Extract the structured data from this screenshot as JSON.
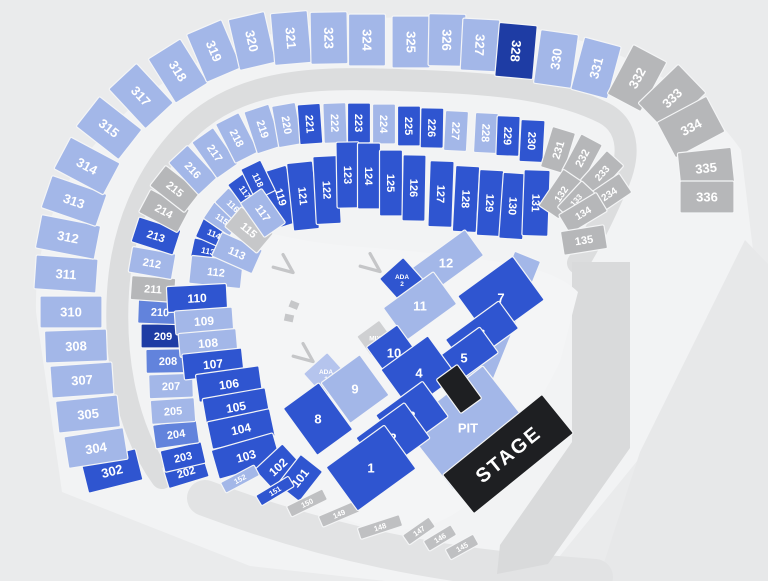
{
  "seat_map": {
    "palette": {
      "light": "#a3b7e8",
      "medium": "#6283dc",
      "royal": "#2f55d0",
      "navy": "#1e3ca4",
      "gray": "#b6b7b9",
      "graylight": "#c6c7c9",
      "strip": "#bfc0c2",
      "ada1": "#b5c4ed",
      "mix": "#cfd0d2",
      "stage": "#1e1f22",
      "stroke": "#f4f5f6",
      "arrow": "#c5c6c8"
    },
    "backdrops": [
      {
        "name": "stadium-footprint",
        "type": "path",
        "fill": "#f2f3f4",
        "d": "M 62 492 L 36 312 Q 33 198 121 117 Q 212 30 362 19 Q 522 8 632 61 Q 703 95 741 150 L 753 250 L 642 455 L 546 573 L 430 586 L 250 566 Z"
      },
      {
        "name": "outer-plaza",
        "type": "path",
        "fill": "#e7e8e9",
        "d": "M 745 240 L 768 264 L 768 581 L 598 581 L 640 452 Z"
      },
      {
        "name": "bottom-walkway",
        "type": "path",
        "stroke": "#e2e3e4",
        "w": 36,
        "d": "M 205 498 Q 360 556 520 571 L 595 577"
      },
      {
        "name": "concourse-ring",
        "type": "path",
        "stroke": "#dcddde",
        "w": 22,
        "d": "M 162 478 C 126 428 114 358 118 292 C 122 226 148 167 193 125 C 252 72 340 78 424 81 C 504 84 560 91 604 113 C 627 125 631 151 619 181 C 607 209 593 239 578 263"
      },
      {
        "name": "stage-right-walkway",
        "type": "path",
        "fill": "#d9dadb",
        "d": "M 572 262 L 630 262 L 630 448 L 548 564 L 497 574 L 500 545 L 572 442 Z"
      },
      {
        "name": "field-floor",
        "type": "path",
        "fill": "#f4f5f6",
        "d": "M 212 300 Q 214 242 252 228 Q 302 243 362 247 Q 432 252 500 262 Q 556 270 578 292 L 560 362 Q 520 442 470 502 Q 420 546 350 521 Q 272 492 237 452 Q 209 400 212 300 Z"
      },
      {
        "name": "wall-block",
        "type": "rect",
        "x": 294,
        "y": 305,
        "w": 9,
        "h": 7,
        "r": 22,
        "fill": "#c6c7c9"
      },
      {
        "name": "wall-block",
        "type": "rect",
        "x": 289,
        "y": 318,
        "w": 9,
        "h": 7,
        "r": 12,
        "fill": "#c6c7c9"
      }
    ],
    "sections": [
      [
        "302",
        112,
        471,
        56,
        32,
        -14,
        "royal",
        13
      ],
      [
        "304",
        96,
        448,
        60,
        32,
        -9,
        "light",
        13
      ],
      [
        "305",
        88,
        414,
        62,
        32,
        -6,
        "light",
        13
      ],
      [
        "307",
        82,
        380,
        62,
        32,
        -4,
        "light",
        13
      ],
      [
        "308",
        76,
        346,
        62,
        32,
        -2,
        "light",
        13
      ],
      [
        "310",
        71,
        312,
        62,
        32,
        0,
        "light",
        13
      ],
      [
        "311",
        66,
        274,
        62,
        34,
        4,
        "light",
        13
      ],
      [
        "312",
        68,
        237,
        60,
        34,
        11,
        "light",
        13
      ],
      [
        "313",
        74,
        201,
        58,
        34,
        19,
        "light",
        13
      ],
      [
        "314",
        87,
        166,
        56,
        36,
        28,
        "light",
        13
      ],
      [
        "315",
        109,
        128,
        54,
        38,
        38,
        "light",
        13
      ],
      [
        "317",
        141,
        96,
        54,
        38,
        47,
        "light",
        13
      ],
      [
        "318",
        178,
        71,
        52,
        38,
        58,
        "light",
        13
      ],
      [
        "319",
        214,
        51,
        52,
        38,
        67,
        "light",
        13
      ],
      [
        "320",
        252,
        41,
        52,
        37,
        77,
        "light",
        13
      ],
      [
        "321",
        291,
        38,
        52,
        37,
        85,
        "light",
        13
      ],
      [
        "323",
        329,
        38,
        52,
        37,
        89,
        "light",
        13
      ],
      [
        "324",
        367,
        40,
        52,
        37,
        90,
        "light",
        13
      ],
      [
        "325",
        411,
        42,
        52,
        38,
        90,
        "light",
        13
      ],
      [
        "326",
        447,
        40,
        52,
        37,
        91,
        "light",
        13
      ],
      [
        "327",
        480,
        45,
        52,
        37,
        93,
        "light",
        13
      ],
      [
        "328",
        516,
        51,
        54,
        38,
        95,
        "navy",
        13
      ],
      [
        "330",
        556,
        59,
        54,
        38,
        -82,
        "light",
        13
      ],
      [
        "331",
        596,
        68,
        54,
        38,
        -75,
        "light",
        13
      ],
      [
        "332",
        637,
        78,
        56,
        38,
        -62,
        "gray",
        13
      ],
      [
        "333",
        672,
        98,
        56,
        40,
        -44,
        "gray",
        13
      ],
      [
        "334",
        691,
        127,
        56,
        40,
        -28,
        "gray",
        13
      ],
      [
        "335",
        706,
        168,
        54,
        36,
        -6,
        "gray",
        13
      ],
      [
        "336",
        707,
        197,
        54,
        32,
        0,
        "gray",
        13
      ],
      [
        "202",
        186,
        472,
        42,
        22,
        -17,
        "royal",
        11
      ],
      [
        "203",
        183,
        457,
        42,
        22,
        -13,
        "royal",
        11
      ],
      [
        "204",
        176,
        434,
        44,
        24,
        -8,
        "medium",
        11
      ],
      [
        "205",
        173,
        411,
        44,
        24,
        -4,
        "light",
        11
      ],
      [
        "207",
        171,
        386,
        44,
        24,
        -2,
        "light",
        11
      ],
      [
        "208",
        168,
        361,
        44,
        24,
        -1,
        "medium",
        11
      ],
      [
        "209",
        163,
        336,
        44,
        24,
        0,
        "navy",
        11
      ],
      [
        "210",
        160,
        312,
        44,
        24,
        2,
        "medium",
        11
      ],
      [
        "211",
        153,
        289,
        44,
        24,
        4,
        "gray",
        11
      ],
      [
        "212",
        152,
        263,
        44,
        26,
        10,
        "light",
        11
      ],
      [
        "213",
        156,
        236,
        44,
        26,
        18,
        "royal",
        11
      ],
      [
        "214",
        164,
        211,
        44,
        26,
        28,
        "gray",
        11
      ],
      [
        "215",
        175,
        189,
        44,
        26,
        38,
        "gray",
        11
      ],
      [
        "216",
        193,
        170,
        44,
        26,
        47,
        "light",
        11
      ],
      [
        "217",
        215,
        153,
        44,
        26,
        55,
        "light",
        11
      ],
      [
        "218",
        237,
        138,
        44,
        26,
        63,
        "light",
        11
      ],
      [
        "219",
        263,
        129,
        44,
        26,
        72,
        "light",
        11
      ],
      [
        "220",
        287,
        125,
        42,
        24,
        80,
        "light",
        11
      ],
      [
        "221",
        310,
        124,
        40,
        23,
        86,
        "royal",
        11
      ],
      [
        "222",
        335,
        123,
        40,
        23,
        88,
        "light",
        11
      ],
      [
        "223",
        359,
        123,
        40,
        23,
        90,
        "royal",
        11
      ],
      [
        "224",
        384,
        124,
        40,
        23,
        90,
        "light",
        11
      ],
      [
        "225",
        409,
        126,
        40,
        23,
        90,
        "royal",
        11
      ],
      [
        "226",
        432,
        128,
        40,
        23,
        91,
        "royal",
        11
      ],
      [
        "227",
        456,
        131,
        40,
        23,
        93,
        "light",
        11
      ],
      [
        "228",
        486,
        133,
        40,
        23,
        93,
        "light",
        11
      ],
      [
        "229",
        508,
        136,
        40,
        23,
        92,
        "royal",
        11
      ],
      [
        "230",
        532,
        141,
        42,
        24,
        93,
        "royal",
        11
      ],
      [
        "231",
        558,
        150,
        42,
        24,
        -73,
        "gray",
        11
      ],
      [
        "232",
        582,
        158,
        42,
        24,
        -62,
        "gray",
        11
      ],
      [
        "233",
        602,
        173,
        40,
        23,
        -48,
        "gray",
        10
      ],
      [
        "234",
        609,
        194,
        40,
        23,
        -34,
        "gray",
        10
      ],
      [
        "119",
        281,
        197,
        58,
        28,
        73,
        "royal",
        11
      ],
      [
        "121",
        303,
        196,
        68,
        26,
        84,
        "royal",
        11
      ],
      [
        "122",
        327,
        190,
        68,
        25,
        87,
        "royal",
        11
      ],
      [
        "123",
        348,
        175,
        66,
        23,
        89,
        "royal",
        11
      ],
      [
        "124",
        369,
        176,
        66,
        23,
        90,
        "royal",
        11
      ],
      [
        "125",
        391,
        183,
        66,
        23,
        90,
        "royal",
        11
      ],
      [
        "126",
        414,
        188,
        66,
        23,
        91,
        "royal",
        11
      ],
      [
        "127",
        441,
        194,
        66,
        24,
        92,
        "royal",
        11
      ],
      [
        "128",
        466,
        199,
        66,
        24,
        93,
        "royal",
        11
      ],
      [
        "129",
        490,
        203,
        66,
        24,
        93,
        "royal",
        11
      ],
      [
        "130",
        513,
        206,
        66,
        24,
        94,
        "royal",
        11
      ],
      [
        "131",
        536,
        203,
        66,
        26,
        92,
        "royal",
        11
      ],
      [
        "132",
        561,
        194,
        44,
        24,
        -56,
        "gray",
        10
      ],
      [
        "133",
        576,
        200,
        36,
        18,
        -47,
        "gray",
        8
      ],
      [
        "134",
        583,
        213,
        44,
        22,
        -31,
        "gray",
        10
      ],
      [
        "135",
        584,
        240,
        44,
        24,
        -9,
        "gray",
        11
      ],
      [
        "113",
        208,
        251,
        32,
        20,
        12,
        "royal",
        8.5
      ],
      [
        "114",
        214,
        234,
        32,
        20,
        24,
        "royal",
        8.5
      ],
      [
        "115",
        222,
        219,
        32,
        20,
        34,
        "light",
        8.5
      ],
      [
        "116",
        233,
        206,
        32,
        20,
        44,
        "light",
        8.5
      ],
      [
        "117",
        245,
        192,
        32,
        20,
        54,
        "royal",
        8.5
      ],
      [
        "118",
        258,
        180,
        34,
        22,
        64,
        "royal",
        9
      ],
      [
        "112",
        216,
        272,
        52,
        28,
        6,
        "light",
        11
      ],
      [
        "113",
        237,
        253,
        44,
        26,
        24,
        "light",
        11
      ],
      [
        "115",
        249,
        230,
        42,
        26,
        40,
        "graylight",
        11
      ],
      [
        "117",
        263,
        213,
        42,
        26,
        55,
        "light",
        11
      ],
      [
        "110",
        197,
        298,
        60,
        26,
        -3,
        "royal",
        12
      ],
      [
        "109",
        204,
        321,
        58,
        24,
        -4,
        "light",
        12
      ],
      [
        "108",
        208,
        343,
        58,
        24,
        -5,
        "light",
        12
      ],
      [
        "107",
        213,
        364,
        60,
        26,
        -6,
        "royal",
        12
      ],
      [
        "106",
        229,
        384,
        64,
        28,
        -8,
        "royal",
        12
      ],
      [
        "105",
        236,
        407,
        64,
        28,
        -10,
        "royal",
        12
      ],
      [
        "104",
        241,
        429,
        64,
        28,
        -12,
        "royal",
        12
      ],
      [
        "103",
        246,
        456,
        64,
        30,
        -16,
        "royal",
        12
      ],
      [
        "102",
        278,
        467,
        38,
        28,
        -43,
        "royal",
        12
      ],
      [
        "101",
        300,
        478,
        38,
        28,
        -52,
        "royal",
        12
      ],
      [
        "152",
        240,
        479,
        38,
        12,
        -28,
        "light",
        7.5
      ],
      [
        "151",
        275,
        491,
        38,
        12,
        -31,
        "royal",
        7.5
      ],
      [
        "150",
        307,
        503,
        40,
        12,
        -26,
        "strip",
        7.5
      ],
      [
        "149",
        339,
        514,
        40,
        12,
        -23,
        "strip",
        7.5
      ],
      [
        "148",
        380,
        527,
        44,
        12,
        -18,
        "strip",
        7.5
      ],
      [
        "147",
        419,
        531,
        32,
        12,
        -35,
        "strip",
        7.5
      ],
      [
        "146",
        440,
        538,
        32,
        12,
        -31,
        "strip",
        7.5
      ],
      [
        "145",
        462,
        547,
        32,
        12,
        -29,
        "strip",
        7.5
      ],
      [
        "",
        500,
        325,
        148,
        28,
        -68,
        "light",
        0,
        "H"
      ],
      [
        "PIT",
        468,
        428,
        100,
        80,
        -38,
        "light",
        13,
        "H"
      ],
      [
        "12",
        446,
        263,
        70,
        32,
        -36,
        "light",
        13,
        "H"
      ],
      [
        "ADA\n2",
        402,
        280,
        32,
        32,
        -42,
        "royal",
        6.5,
        "H"
      ],
      [
        "11",
        420,
        306,
        62,
        40,
        -36,
        "light",
        13,
        "H"
      ],
      [
        "MIX",
        375,
        338,
        28,
        24,
        -36,
        "mix",
        6.5,
        "H"
      ],
      [
        "10",
        394,
        353,
        38,
        42,
        -36,
        "royal",
        13,
        "H"
      ],
      [
        "ADA\n1",
        326,
        375,
        32,
        32,
        -42,
        "ada1",
        6.5,
        "H"
      ],
      [
        "9",
        355,
        389,
        48,
        50,
        -36,
        "light",
        13,
        "H"
      ],
      [
        "8",
        318,
        419,
        44,
        58,
        -36,
        "royal",
        13,
        "H"
      ],
      [
        "7",
        501,
        298,
        68,
        54,
        -36,
        "royal",
        13,
        "H"
      ],
      [
        "6",
        482,
        334,
        66,
        34,
        -36,
        "royal",
        13,
        "H"
      ],
      [
        "5",
        464,
        358,
        62,
        32,
        -36,
        "royal",
        13,
        "H"
      ],
      [
        "4",
        419,
        373,
        58,
        50,
        -36,
        "royal",
        13,
        "H"
      ],
      [
        "3",
        412,
        416,
        58,
        44,
        -36,
        "royal",
        13,
        "H"
      ],
      [
        "2",
        393,
        438,
        60,
        44,
        -36,
        "royal",
        13,
        "H"
      ],
      [
        "1",
        371,
        468,
        72,
        54,
        -36,
        "royal",
        13,
        "H"
      ],
      [
        "",
        459,
        389,
        26,
        42,
        -36,
        "stage",
        0,
        "H"
      ],
      [
        "STAGE",
        508,
        454,
        128,
        50,
        -39,
        "stage",
        20
      ]
    ],
    "arrows": [
      {
        "name": "entry-arrow",
        "x": 286,
        "y": 267,
        "r": 38
      },
      {
        "name": "entry-arrow",
        "x": 373,
        "y": 266,
        "r": 38
      },
      {
        "name": "entry-arrow",
        "x": 306,
        "y": 356,
        "r": 38
      }
    ]
  }
}
